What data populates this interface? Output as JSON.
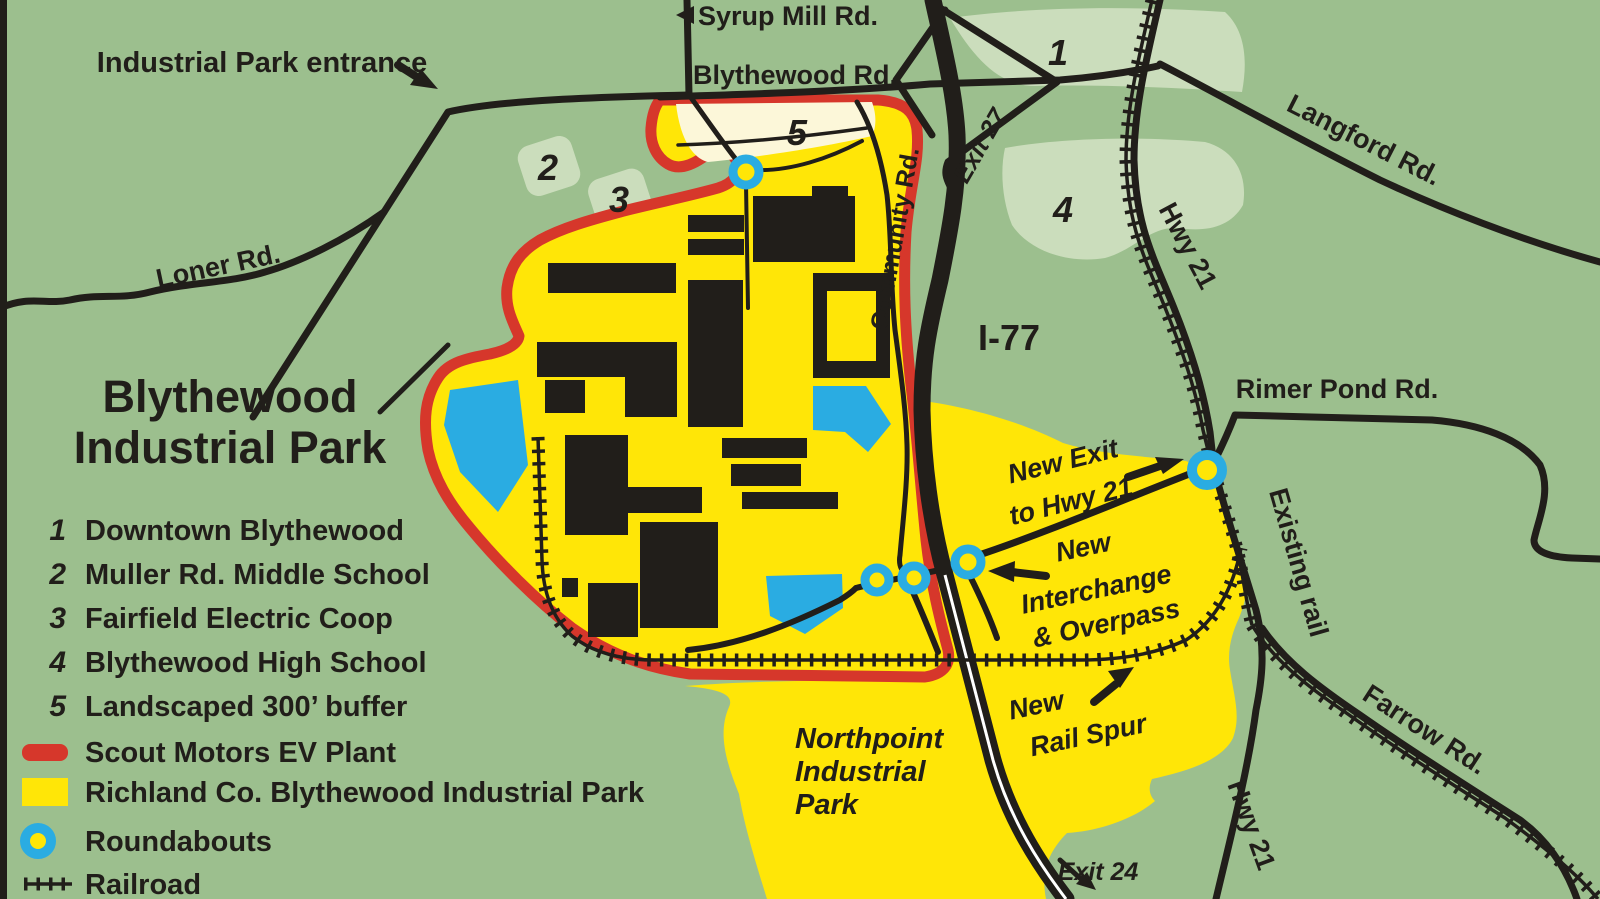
{
  "title": {
    "line1": "Blythewood",
    "line2": "Industrial Park"
  },
  "legend": {
    "items": [
      {
        "num": "1",
        "label": "Downtown Blythewood"
      },
      {
        "num": "2",
        "label": "Muller Rd. Middle School"
      },
      {
        "num": "3",
        "label": "Fairfield Electric Coop"
      },
      {
        "num": "4",
        "label": "Blythewood High School"
      },
      {
        "num": "5",
        "label": "Landscaped 300’ buffer"
      }
    ],
    "scout_label": "Scout Motors EV Plant",
    "richland_label": "Richland Co. Blythewood Industrial Park",
    "roundabouts_label": "Roundabouts",
    "railroad_label": "Railroad"
  },
  "roads": {
    "syrup_mill": "Syrup Mill Rd.",
    "blythewood": "Blythewood Rd.",
    "loner": "Loner Rd.",
    "langford": "Langford Rd.",
    "hwy21": "Hwy 21",
    "rimer_pond": "Rimer Pond Rd.",
    "farrow": "Farrow Rd.",
    "community": "Community Rd.",
    "i77": "I-77",
    "exit27": "Exit 27",
    "exit24": "Exit 24"
  },
  "annotations": {
    "entrance": "Industrial Park entrance",
    "existing_rail": "Existing rail",
    "new_exit_l1": "New Exit",
    "new_exit_l2": "to Hwy 21",
    "interchange_l1": "New",
    "interchange_l2": "Interchange",
    "interchange_l3": "& Overpass",
    "rail_spur_l1": "New",
    "rail_spur_l2": "Rail Spur",
    "northpoint_l1": "Northpoint",
    "northpoint_l2": "Industrial",
    "northpoint_l3": "Park"
  },
  "map_numbers": {
    "n1": "1",
    "n2": "2",
    "n3": "3",
    "n4": "4",
    "n5": "5"
  },
  "colors": {
    "background_green": "#9CBF8E",
    "highlight_green": "#CBDDBC",
    "industrial_yellow": "#FFE607",
    "buffer_cream": "#FCF7D9",
    "scout_red": "#D6372B",
    "roundabout_blue": "#2AACE2",
    "road_black": "#211E1A",
    "pond_blue": "#2AACE2"
  }
}
